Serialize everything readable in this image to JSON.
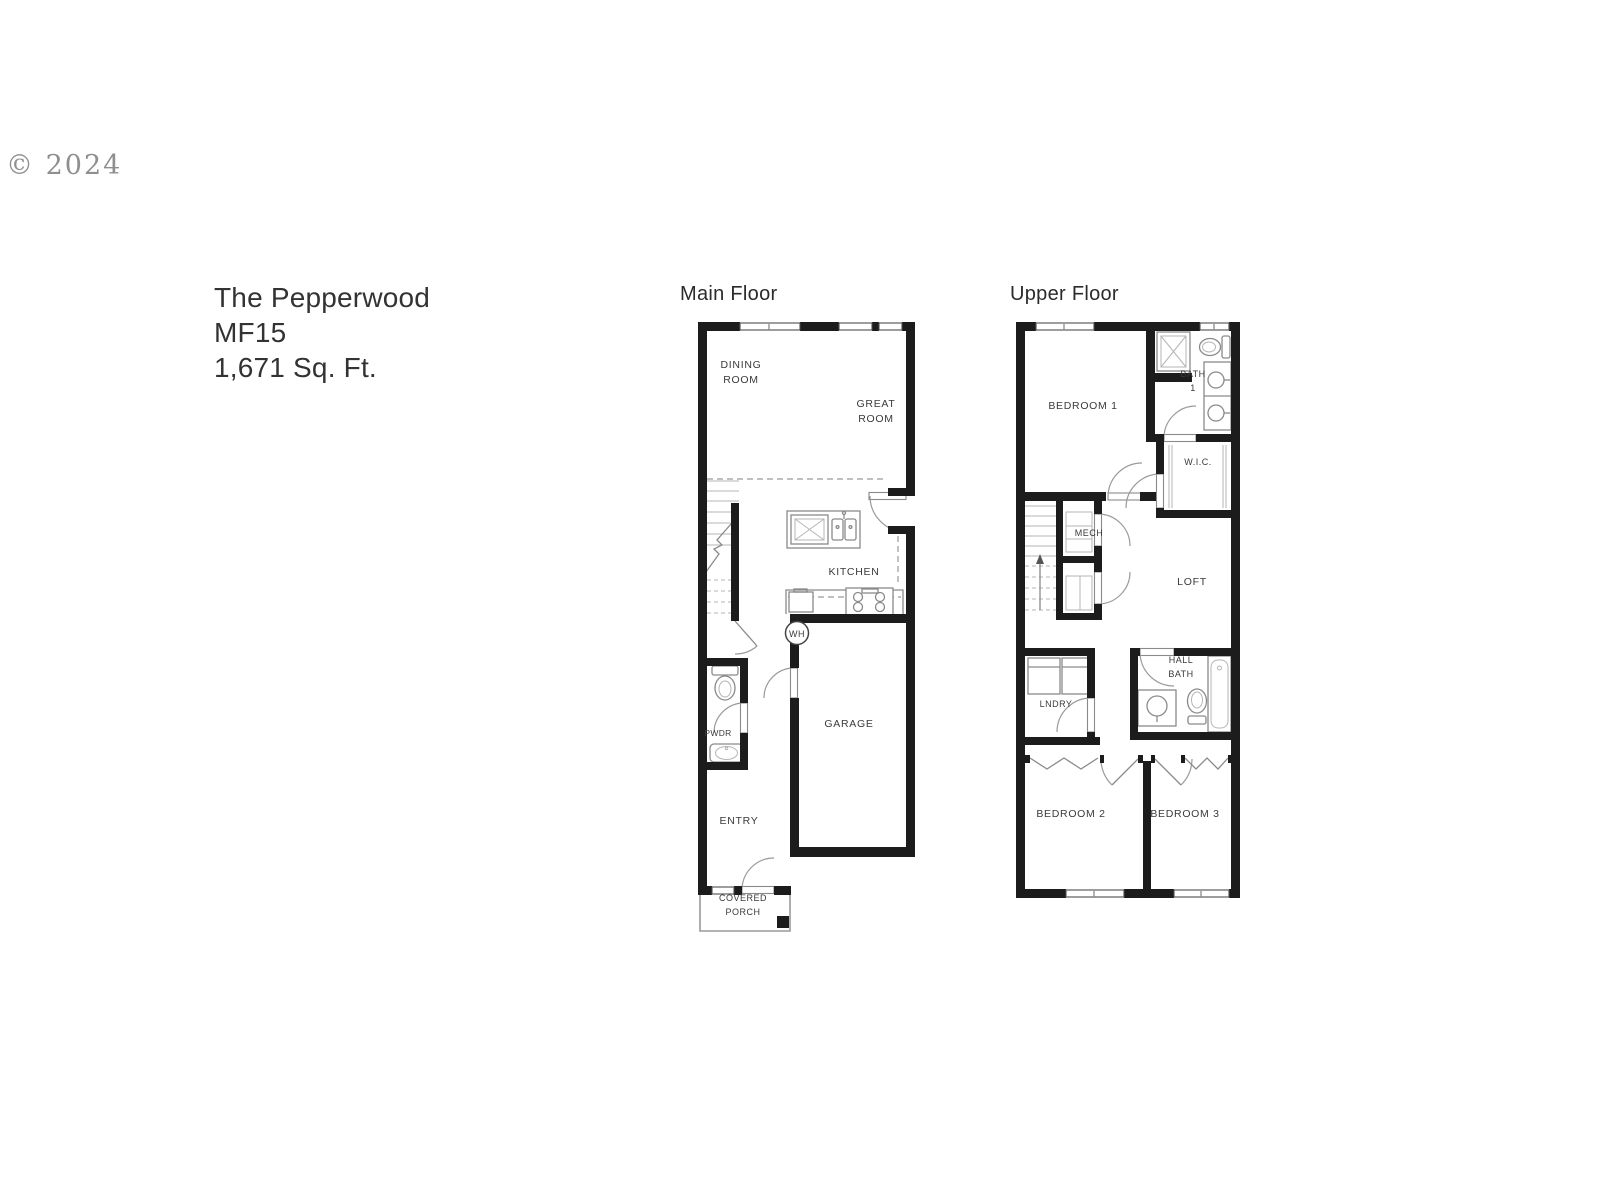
{
  "page": {
    "copyright": "© 2024"
  },
  "title": {
    "name": "The Pepperwood",
    "model": "MF15",
    "area": "1,671 Sq. Ft."
  },
  "main_floor": {
    "heading": "Main Floor",
    "labels": {
      "dining_1": "DINING",
      "dining_2": "ROOM",
      "great_1": "GREAT",
      "great_2": "ROOM",
      "kitchen": "KITCHEN",
      "wh": "WH",
      "pwdr": "PWDR",
      "garage": "GARAGE",
      "entry": "ENTRY",
      "porch_1": "COVERED",
      "porch_2": "PORCH"
    }
  },
  "upper_floor": {
    "heading": "Upper Floor",
    "labels": {
      "bedroom1": "BEDROOM 1",
      "bath1_1": "BATH",
      "bath1_2": "1",
      "wic": "W.I.C.",
      "mech": "MECH",
      "loft": "LOFT",
      "hallbath_1": "HALL",
      "hallbath_2": "BATH",
      "lndry": "LNDRY",
      "bedroom2": "BEDROOM 2",
      "bedroom3": "BEDROOM 3"
    }
  },
  "colors": {
    "wall": "#1c1c1c",
    "thin_line": "#8a8a8a",
    "label": "#3a3a3a"
  }
}
